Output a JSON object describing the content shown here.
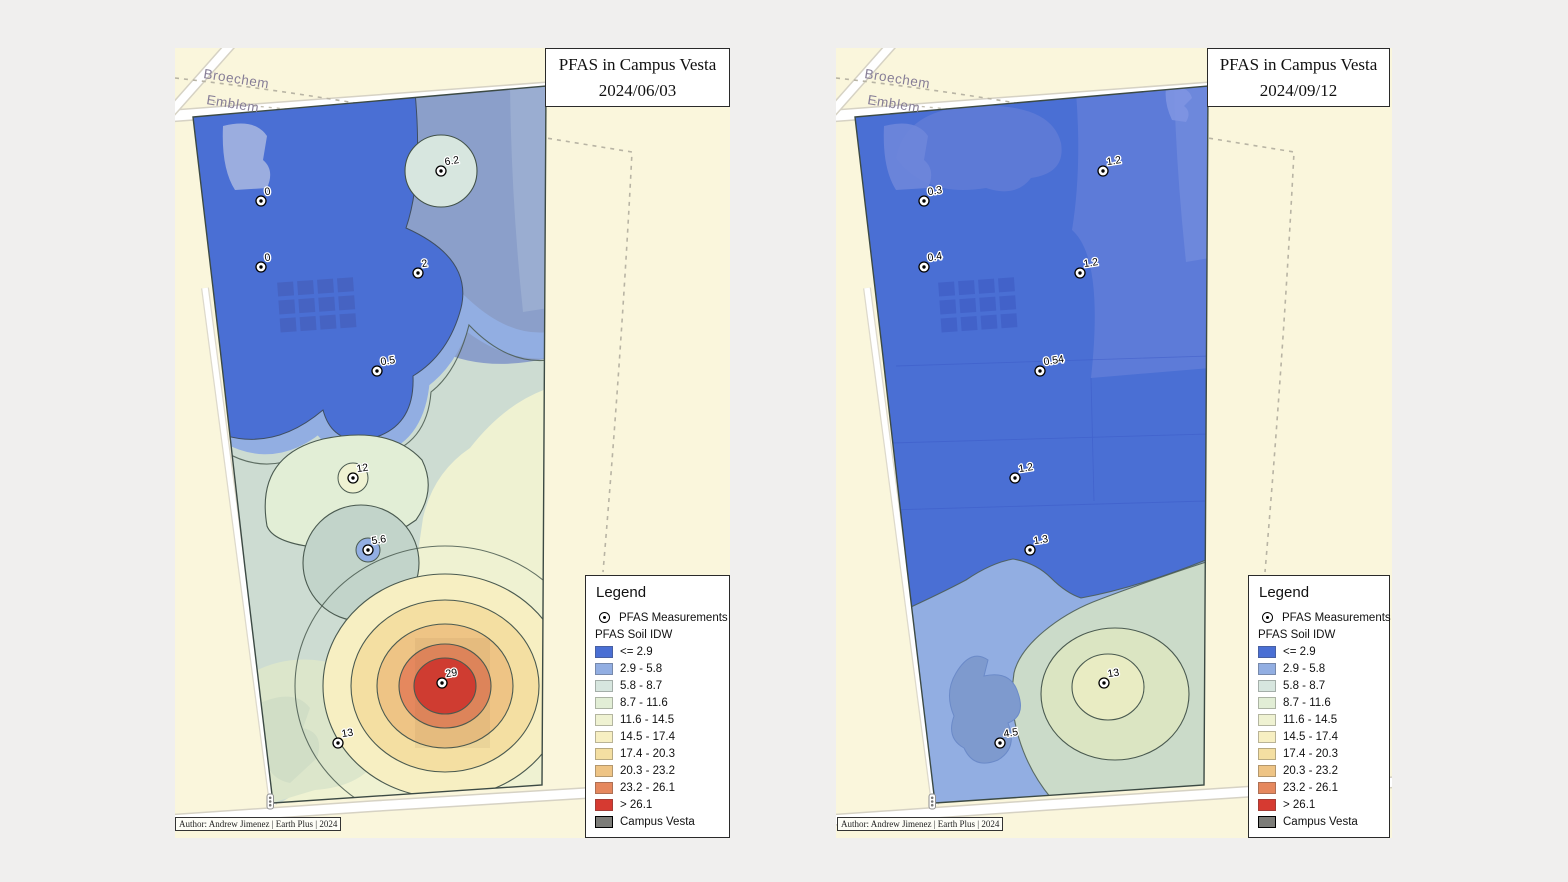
{
  "page": {
    "background": "#f0efee"
  },
  "legend": {
    "title": "Legend",
    "measurements_label": "PFAS Measurements",
    "idw_label": "PFAS Soil IDW",
    "classes": [
      {
        "label": "<= 2.9",
        "color": "#4a6fd4"
      },
      {
        "label": "2.9 - 5.8",
        "color": "#92aee2"
      },
      {
        "label": "5.8 - 8.7",
        "color": "#d7e6df"
      },
      {
        "label": "8.7 - 11.6",
        "color": "#e2eed6"
      },
      {
        "label": "11.6 - 14.5",
        "color": "#eff2d2"
      },
      {
        "label": "14.5 - 17.4",
        "color": "#f7efc2"
      },
      {
        "label": "17.4 - 20.3",
        "color": "#f4dfa2"
      },
      {
        "label": "20.3 - 23.2",
        "color": "#eec485"
      },
      {
        "label": "23.2 - 26.1",
        "color": "#e5885e"
      },
      {
        "label": "> 26.1",
        "color": "#d63a31"
      }
    ],
    "campus": {
      "label": "Campus Vesta",
      "color": "#7c7c78"
    }
  },
  "maps": {
    "left": {
      "title_line1": "PFAS in Campus Vesta",
      "title_line2": "2024/06/03",
      "streets": {
        "broechem": "Broechem",
        "emblem": "Emblem"
      },
      "author": "Author: Andrew Jimenez | Earth Plus | 2024",
      "points": [
        {
          "value": "0"
        },
        {
          "value": "6.2"
        },
        {
          "value": "0"
        },
        {
          "value": "2"
        },
        {
          "value": "0.5"
        },
        {
          "value": "12"
        },
        {
          "value": "5.6"
        },
        {
          "value": "29"
        },
        {
          "value": "13"
        }
      ]
    },
    "right": {
      "title_line1": "PFAS in Campus Vesta",
      "title_line2": "2024/09/12",
      "streets": {
        "broechem": "Broechem",
        "emblem": "Emblem"
      },
      "author": "Author: Andrew Jimenez | Earth Plus | 2024",
      "points": [
        {
          "value": "0.3"
        },
        {
          "value": "1.2"
        },
        {
          "value": "0.4"
        },
        {
          "value": "1.2"
        },
        {
          "value": "0.54"
        },
        {
          "value": "1.2"
        },
        {
          "value": "1.3"
        },
        {
          "value": "13"
        },
        {
          "value": "4.5"
        }
      ]
    }
  }
}
